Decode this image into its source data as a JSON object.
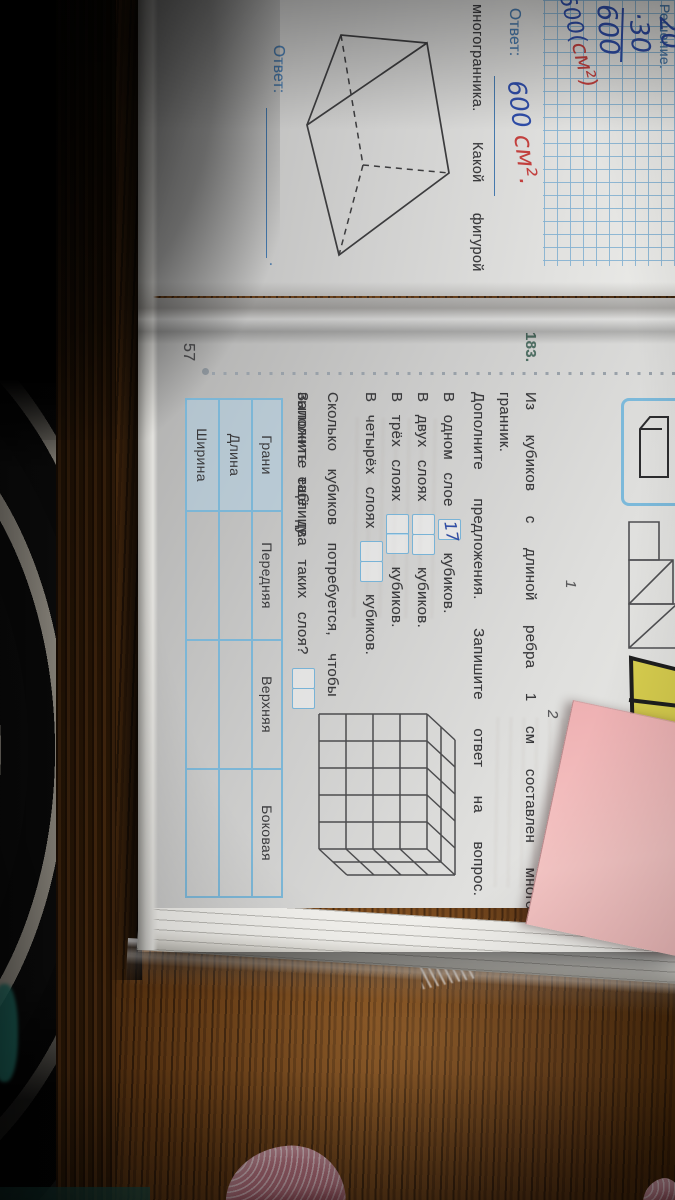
{
  "colors": {
    "wood": "#6b3e15",
    "paper": "#d9d9d7",
    "ink_blue": "#2f4da8",
    "ink_red": "#c2403e",
    "print_blue": "#4579ad",
    "print_black": "#3a3a3c",
    "task_number_green": "#4e6f63",
    "box_blue": "#79b3d6",
    "note_pink": "#f2bdbd",
    "fabric_stripe": "#cfc8ba",
    "teal": "#2d9c8e",
    "slipper_pink": "#dd96a2"
  },
  "left_page": {
    "solution_label": "Решение.",
    "work_line1": "20",
    "work_line2": "·30",
    "work_result": "600",
    "work_units_blue": "600(",
    "work_units_red": "см²)",
    "answer_label": "Ответ:",
    "answer_value_blue": "600",
    "answer_value_red": "см²",
    "answer_period": ".",
    "text_fragment": "многогранника. Какой фигурой",
    "bottom_answer_label": "Ответ:",
    "bottom_answer_period": "."
  },
  "right_page": {
    "page_number": "57",
    "task_number": "183.",
    "figure1_label": "1",
    "figure2_label": "2",
    "intro_line1": "Из кубиков с длиной ребра 1 см составлен много-",
    "intro_line2": "гранник.",
    "intro_line3": "Дополните предложения. Запишите ответ на вопрос.",
    "layers": [
      {
        "text": "В одном слое",
        "answer": "17",
        "suffix": "кубиков."
      },
      {
        "text": "В двух слоях",
        "answer": "",
        "suffix": "кубиков."
      },
      {
        "text": "В трёх слоях",
        "answer": "",
        "suffix": "кубиков."
      },
      {
        "text": "В четырёх слоях",
        "answer": "",
        "suffix": "кубиков."
      }
    ],
    "question_line1": "Сколько кубиков потребуется, чтобы",
    "question_line2": "выложить ещё два таких слоя?",
    "table_caption": "Заполните таблицу.",
    "table": {
      "corner_header": "Грани",
      "columns": [
        "Передняя",
        "Верхняя",
        "Боковая"
      ],
      "rows": [
        "Длина",
        "Ширина"
      ]
    }
  }
}
